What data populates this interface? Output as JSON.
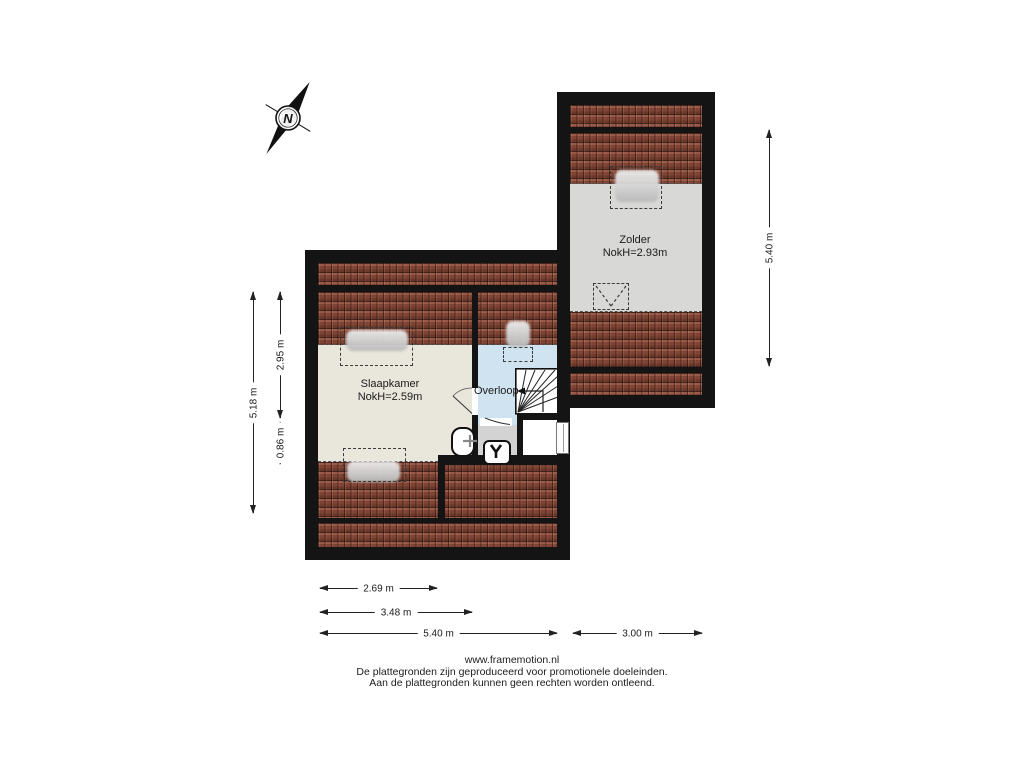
{
  "compass": {
    "letter": "N"
  },
  "rooms": {
    "zolder": {
      "name": "Zolder",
      "ridge": "NokH=2.93m"
    },
    "slaapkamer": {
      "name": "Slaapkamer",
      "ridge": "NokH=2.59m"
    },
    "overloop": {
      "name": "Overloop"
    }
  },
  "dimensions": {
    "left_total": "5.18 m",
    "left_upper": "2.95 m",
    "left_lower": "0.86 m",
    "right_total": "5.40 m",
    "bottom_width_1": "2.69 m",
    "bottom_width_2": "3.48 m",
    "bottom_width_3": "5.40 m",
    "bottom_width_4": "3.00 m"
  },
  "footer": {
    "website": "www.framemotion.nl",
    "disclaimer_line_1": "De plattegronden zijn geproduceerd voor promotionele doeleinden.",
    "disclaimer_line_2": "Aan de plattegronden kunnen geen rechten worden ontleend."
  },
  "colors": {
    "wall": "#141414",
    "roof_tiles": "#7d4536",
    "floor_slaapkamer": "#e9e6db",
    "floor_zolder": "#d8d8d7",
    "floor_overloop": "#cfe3f1",
    "floor_wc": "#d3d3d3"
  }
}
